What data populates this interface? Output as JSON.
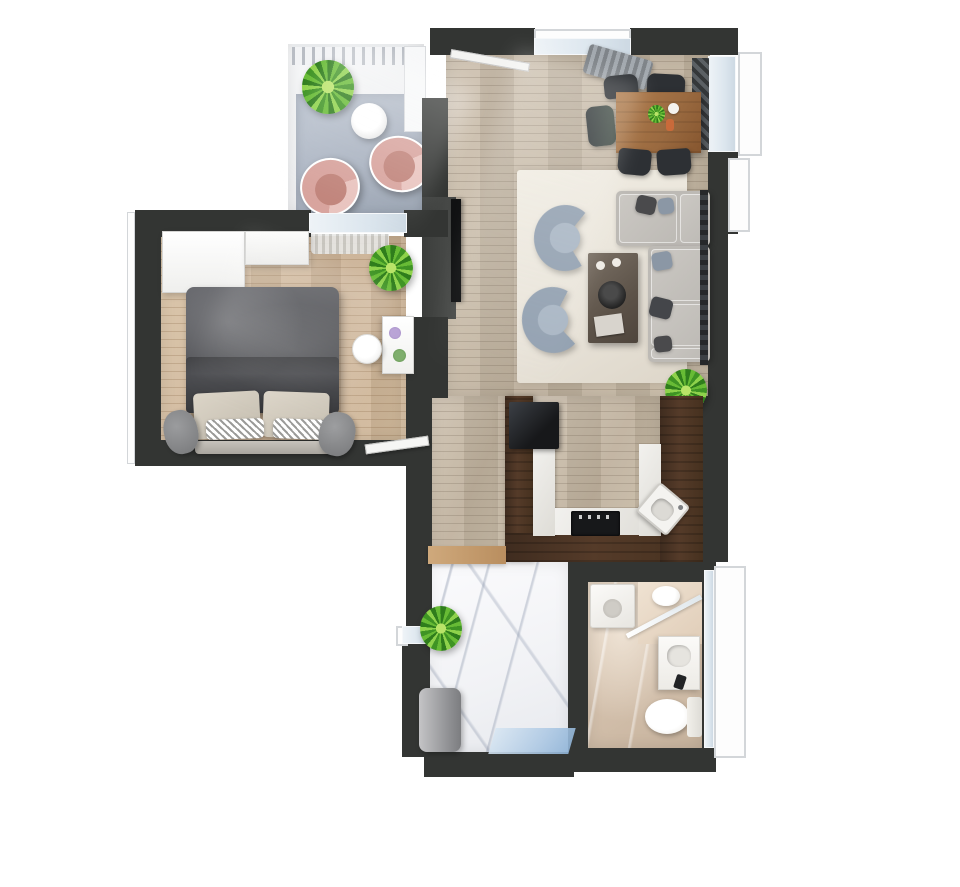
{
  "page": {
    "title": "3D apartment floor plan render, top-down view",
    "background": "#ffffff"
  },
  "colors": {
    "bg": "#ffffff",
    "wall": "#333533",
    "wood-living": "#bfb19d",
    "wood-bedroom": "#c9af92",
    "walnut": "#553b29",
    "marble-white": "#f1f2f5",
    "marble-beige": "#d3c0ac",
    "rug-living": "#e9e4da",
    "rug-balcony": "#a8b1bf",
    "balcony-floor": "#eff0f2",
    "sofa": "#bdbab5",
    "armchair-shell": "#93a1b1",
    "armchair-seat": "#a9b6c4",
    "egg-chair-shell": "#d8a49e",
    "egg-chair-seat": "#c1857c",
    "duvet": "#4c4d51",
    "dining-table": "#9a6a40",
    "dining-chair": "#2d3034",
    "window-glass": "#dce6ee",
    "door-mat": "#aec9e4",
    "plant-green": "#54a52c",
    "appliance-black": "#17181a"
  },
  "rooms": [
    {
      "id": "balcony",
      "kind": "balcony",
      "furniture": [
        "railing",
        "potted-plant",
        "round-side-table",
        "pink-egg-chair",
        "pink-egg-chair",
        "outdoor-rug"
      ]
    },
    {
      "id": "living-dining-room",
      "kind": "living-room",
      "furniture": [
        "window",
        "radiator-bench",
        "dining-table",
        "flower-centerpiece",
        "dining-chair",
        "dining-chair",
        "dining-chair",
        "dining-chair",
        "dining-chair",
        "area-rug",
        "barrel-armchair",
        "barrel-armchair",
        "coffee-table",
        "sectional-sofa",
        "throw-pillows",
        "wall-tv",
        "potted-plant",
        "window-radiator"
      ]
    },
    {
      "id": "bedroom",
      "kind": "bedroom",
      "furniture": [
        "wardrobe",
        "window-to-balcony",
        "curtain",
        "double-bed",
        "duvet",
        "pillows",
        "bench",
        "pouf",
        "pouf",
        "potted-plant",
        "dressing-desk",
        "round-stool",
        "open-door"
      ]
    },
    {
      "id": "kitchen",
      "kind": "kitchen",
      "furniture": [
        "u-shaped-walnut-counter",
        "fridge",
        "cooktop",
        "sink",
        "marble-worktop"
      ]
    },
    {
      "id": "hallway",
      "kind": "entry-hall",
      "furniture": [
        "wood-shelf",
        "potted-plant",
        "laundry-basket",
        "entry-door-mat",
        "window"
      ]
    },
    {
      "id": "bathroom",
      "kind": "bathroom",
      "furniture": [
        "washing-machine",
        "corner-shower",
        "glass-partition",
        "vanity-washbasin",
        "toilet",
        "full-height-window"
      ]
    }
  ]
}
